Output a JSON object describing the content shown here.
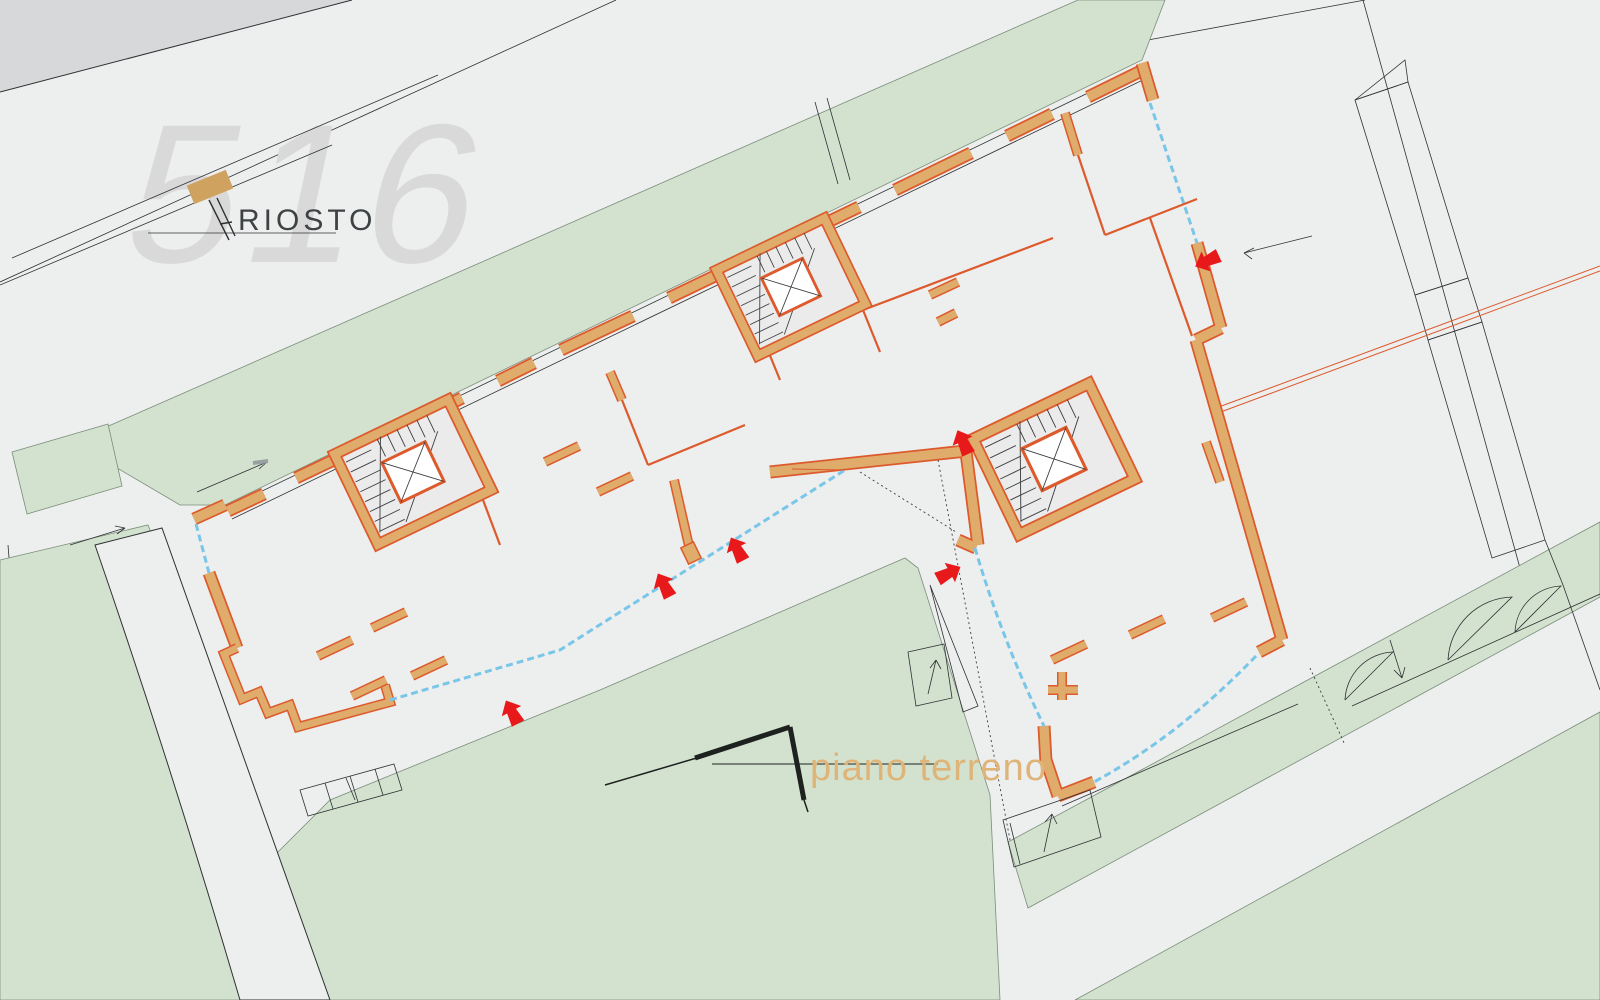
{
  "logo": {
    "number": "516",
    "name": "RIOSTO"
  },
  "labels": {
    "floor": "piano terreno"
  },
  "icons": {
    "entrance_arrow": "bold-red-entry-arrow",
    "direction_arrow": "thin-black-direction-arrow",
    "elevator": "crossed-square-elevator",
    "stairs": "tread-line-stairs"
  },
  "colors": {
    "street": "#edeeee",
    "street_dark": "#d7d8d9",
    "line": "#2e3133",
    "green": "#d3e2cf",
    "green_line": "#7a8d7a",
    "wall_fill": "#e0ac6b",
    "wall_line": "#dc5a2c",
    "glazing": "#79c6e8",
    "arrow_red": "#e7191b",
    "logo_gray": "#d9d9d9",
    "logo_gold": "#d0a260",
    "label_tan": "#dfb478",
    "core_floor": "#ebebec",
    "stair_line": "#3c3f41"
  }
}
